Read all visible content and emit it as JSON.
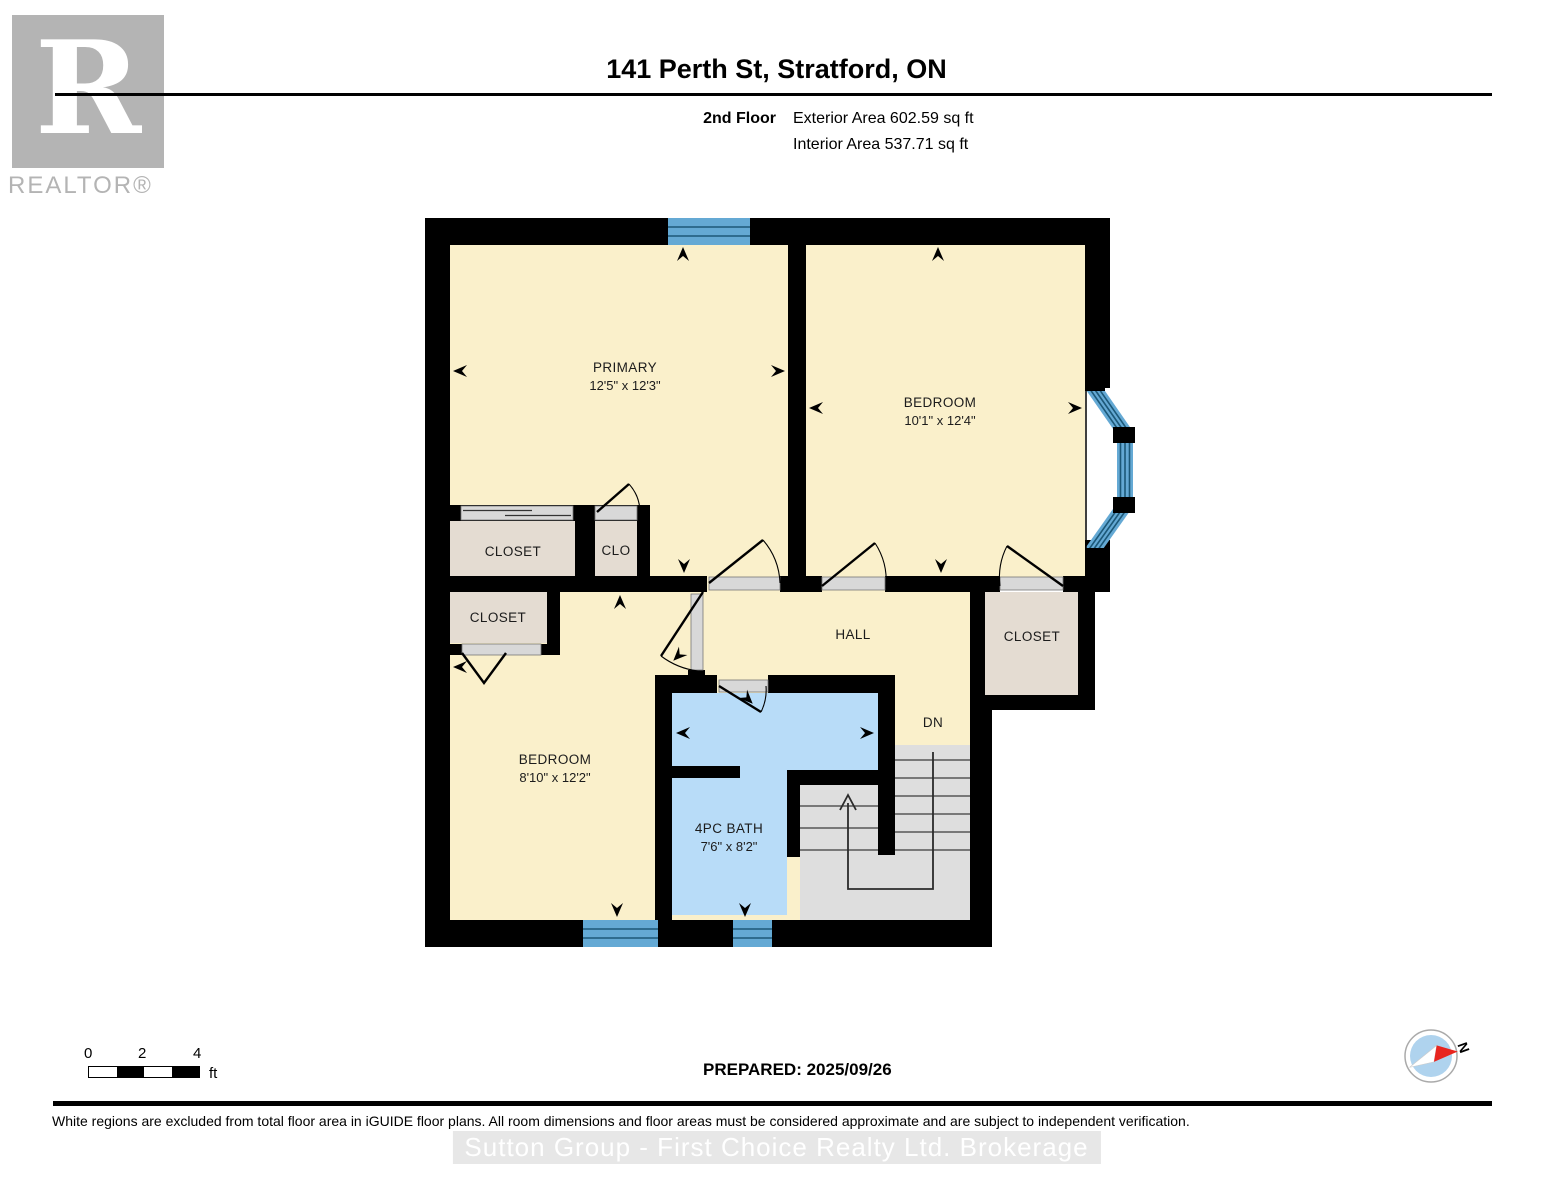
{
  "header": {
    "title": "141 Perth St, Stratford, ON",
    "floor_label": "2nd Floor",
    "exterior_area": "Exterior Area 602.59 sq ft",
    "interior_area": "Interior Area 537.71 sq ft"
  },
  "logo": {
    "letter": "R",
    "wordmark": "REALTOR®"
  },
  "plan": {
    "primary": {
      "name": "PRIMARY",
      "dims": "12'5\" x 12'3\""
    },
    "bedroom2": {
      "name": "BEDROOM",
      "dims": "10'1\" x 12'4\""
    },
    "bedroom1": {
      "name": "BEDROOM",
      "dims": "8'10\" x 12'2\""
    },
    "bath": {
      "name": "4PC BATH",
      "dims": "7'6\" x 8'2\""
    },
    "hall": {
      "name": "HALL"
    },
    "closet1": {
      "name": "CLOSET"
    },
    "clo": {
      "name": "CLO"
    },
    "closet2": {
      "name": "CLOSET"
    },
    "closet3": {
      "name": "CLOSET"
    },
    "stairs": {
      "label": "DN"
    }
  },
  "scalebar": {
    "ticks": [
      "0",
      "2",
      "4"
    ],
    "unit": "ft"
  },
  "compass": {
    "north": "N"
  },
  "footer": {
    "prepared": "PREPARED: 2025/09/26",
    "disclaimer": "White regions are excluded from total floor area in iGUIDE floor plans. All room dimensions and floor areas must be considered approximate and are subject to independent verification.",
    "watermark": "Sutton Group - First Choice Realty Ltd.  Brokerage"
  },
  "colors": {
    "wall": "#000000",
    "room": "#faf0cb",
    "closet": "#e4dcd2",
    "bath": "#b8dcf8",
    "stair": "#dedede",
    "window": "#64a9d4",
    "windowLine": "#1c5878",
    "threshold": "#d8d8d8",
    "label": "#1c1c1c",
    "logoGray": "#b4b4b4"
  }
}
